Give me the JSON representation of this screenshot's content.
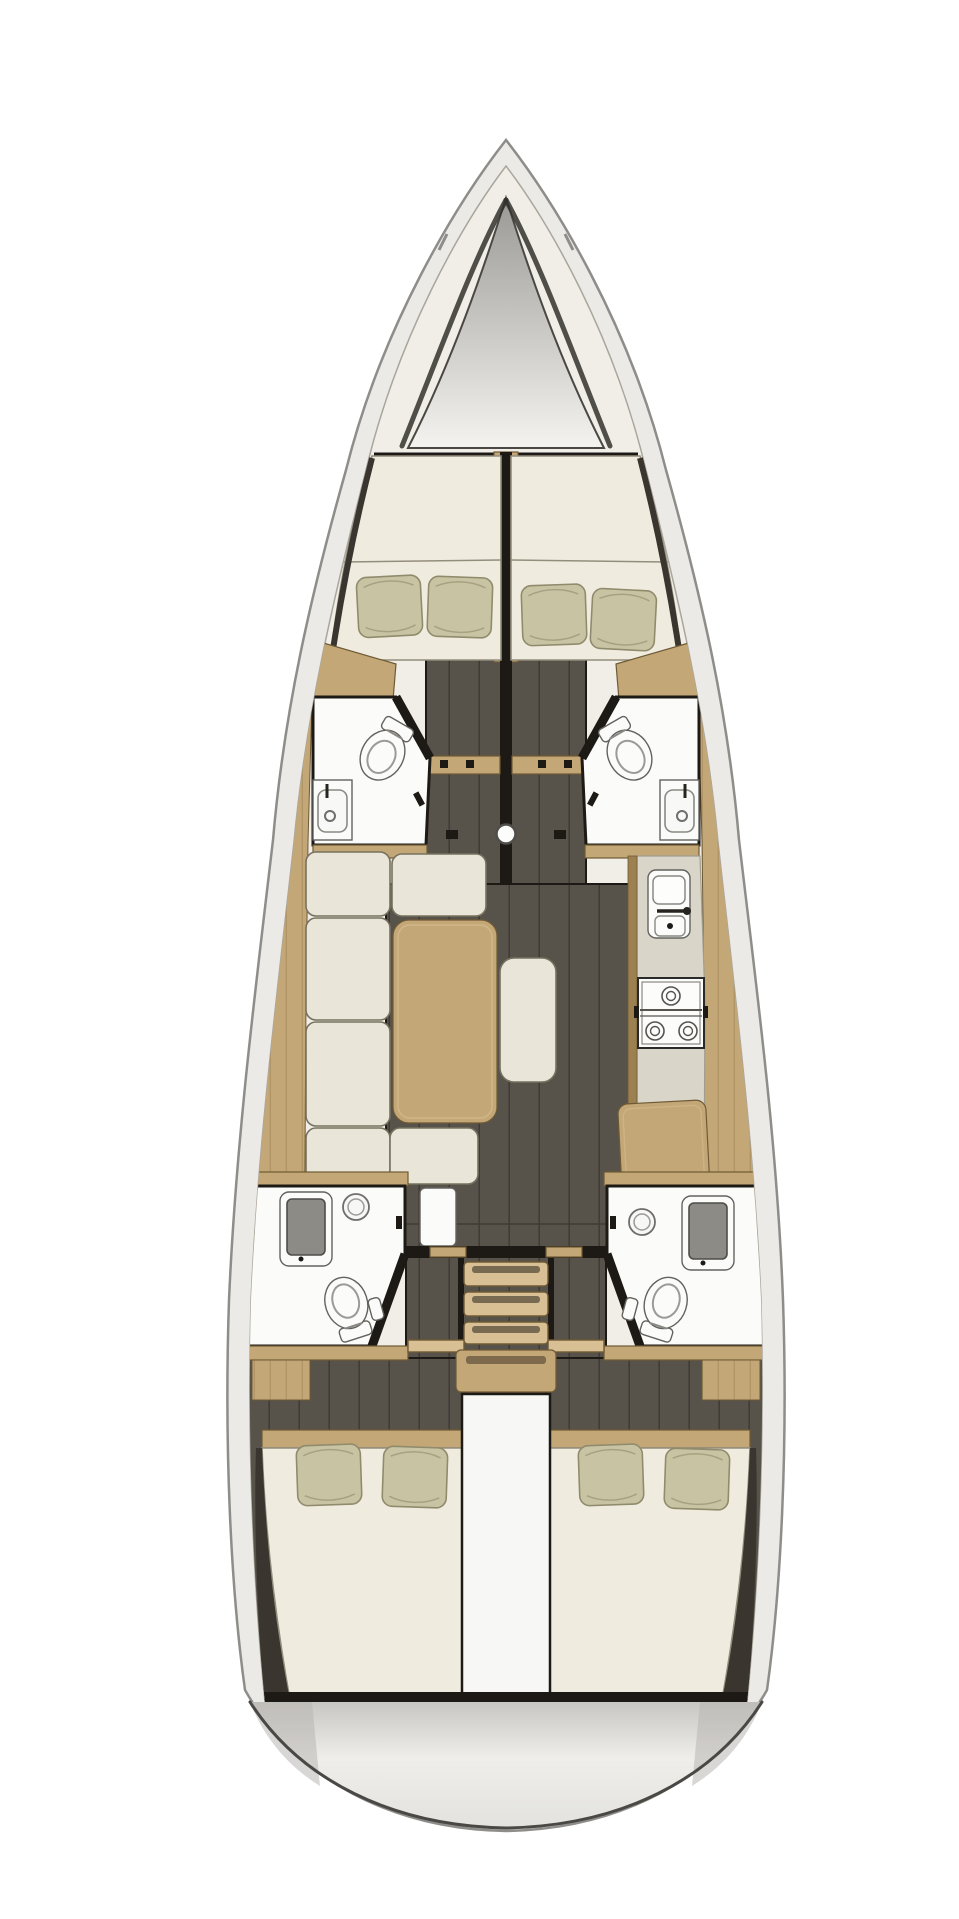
{
  "document": {
    "title": "Sailing yacht interior layout plan, top-down view, bow at top",
    "visible_text": [],
    "image_type": "3D-rendered boat floor plan"
  },
  "colors": {
    "page_bg": "#ffffff",
    "hull_fill": "#ebeae6",
    "hull_line": "#8e8d89",
    "deck_fill": "#f0eee6",
    "deck_line": "#a9a69d",
    "locker_top": "#9b9995",
    "locker_bottom": "#f4f3f0",
    "wall_dark": "#1d1a15",
    "wood": "#c4a777",
    "wood_dark": "#9d8050",
    "wood_light": "#d8c094",
    "wood_line": "#6f5a35",
    "floor_dark": "#57524a",
    "floor_line": "#403c35",
    "mattress": "#efecdf",
    "mattress_line": "#938d7c",
    "pillow": "#c8c4a3",
    "pillow_line": "#8f8b6c",
    "cushion": "#e9e6d9",
    "cushion_line": "#77725f",
    "fixture": "#fbfbf9",
    "fixture_line": "#63625e",
    "counter": "#d9d5c8",
    "counter_line": "#a19d8f",
    "shower_pan": "#8d8b86",
    "shadow_wedge": "#3a362f",
    "transom_top": "#c7c6c2",
    "transom_bottom": "#efeeea",
    "transom_line": "#4a4845"
  },
  "layout": {
    "orientation": "bow-up",
    "symmetry": "port-starboard mirrored",
    "areas": [
      {
        "id": "anchor-locker",
        "label": "Anchor locker",
        "position": "bow"
      },
      {
        "id": "forward-cabin-port",
        "label": "Forward cabin port",
        "features": [
          "V-berth mattress",
          "2 pillows"
        ]
      },
      {
        "id": "forward-cabin-starboard",
        "label": "Forward cabin starboard",
        "features": [
          "V-berth mattress",
          "2 pillows"
        ]
      },
      {
        "id": "forward-head-port",
        "label": "Forward head port",
        "features": [
          "toilet",
          "sink"
        ]
      },
      {
        "id": "forward-head-starboard",
        "label": "Forward head starboard",
        "features": [
          "toilet",
          "sink"
        ]
      },
      {
        "id": "mast",
        "label": "Mast / compression post",
        "position": "centreline"
      },
      {
        "id": "saloon",
        "label": "Saloon",
        "features": [
          "U-shaped settee",
          "dining table",
          "centre bench"
        ]
      },
      {
        "id": "galley",
        "label": "Galley",
        "position": "starboard",
        "features": [
          "sink unit",
          "stove",
          "counter"
        ]
      },
      {
        "id": "nav-station",
        "label": "Chart table",
        "position": "starboard aft"
      },
      {
        "id": "aft-head-port",
        "label": "Aft head port",
        "features": [
          "shower",
          "round sink",
          "toilet"
        ]
      },
      {
        "id": "aft-head-starboard",
        "label": "Aft head starboard",
        "features": [
          "shower",
          "round sink",
          "toilet"
        ]
      },
      {
        "id": "companionway",
        "label": "Companionway stairs",
        "steps": 4
      },
      {
        "id": "engine-compartment",
        "label": "Engine compartment",
        "position": "centre aft"
      },
      {
        "id": "aft-cabin-port",
        "label": "Aft cabin port",
        "features": [
          "double berth",
          "2 pillows"
        ]
      },
      {
        "id": "aft-cabin-starboard",
        "label": "Aft cabin starboard",
        "features": [
          "double berth",
          "2 pillows"
        ]
      },
      {
        "id": "transom",
        "label": "Transom / swim platform",
        "position": "stern"
      }
    ],
    "counts": {
      "cabins": 4,
      "heads": 4,
      "toilets": 4,
      "sinks": 5,
      "showers": 2,
      "pillows": 8,
      "companionway_steps": 4
    }
  }
}
